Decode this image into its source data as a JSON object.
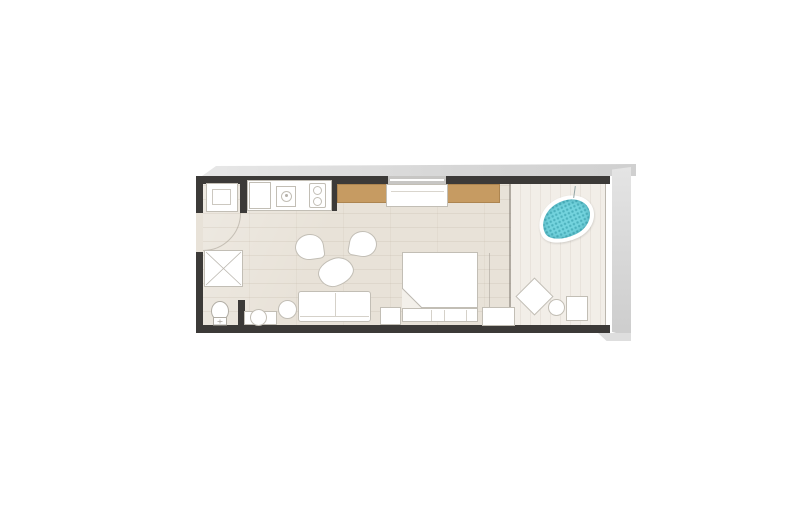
{
  "meta": {
    "type": "architectural-floor-plan",
    "description": "Hotel suite floor plan with kitchenette, bathroom, living-bedroom and terrace with private plunge pool",
    "visible_text": []
  },
  "colors": {
    "background": "#ffffff",
    "wall": "#3c3a38",
    "window": "#c7c6c4",
    "floor_interior": "#e8e2d8",
    "floor_terrace": "#f2eee8",
    "wood": "#c69b62",
    "wood_edge": "#ad8550",
    "pool_water": "#74d4de",
    "pool_dot": "#2e96a3",
    "furniture_fill": "#ffffff",
    "furniture_line": "#c2beb5",
    "slab": "#dadada"
  },
  "rooms": [
    {
      "id": "entry-hall",
      "label": "Entry hall"
    },
    {
      "id": "bathroom",
      "label": "Bathroom"
    },
    {
      "id": "kitchenette",
      "label": "Kitchenette"
    },
    {
      "id": "living-bedroom",
      "label": "Living / bedroom area"
    },
    {
      "id": "terrace",
      "label": "Terrace with plunge pool"
    }
  ],
  "furniture": [
    {
      "id": "washer",
      "label": "Washer / appliance niche"
    },
    {
      "id": "fridge",
      "label": "Refrigerator"
    },
    {
      "id": "kitchen-sink",
      "label": "Kitchen sink"
    },
    {
      "id": "cooktop",
      "label": "Two-burner cooktop"
    },
    {
      "id": "wardrobe",
      "label": "Wardrobe"
    },
    {
      "id": "dresser",
      "label": "Dresser / TV console"
    },
    {
      "id": "shower",
      "label": "Walk-in shower"
    },
    {
      "id": "toilet",
      "label": "Toilet"
    },
    {
      "id": "vanity-sink",
      "label": "Vanity with round basin"
    },
    {
      "id": "armchair",
      "label": "Fan armchair (x2)"
    },
    {
      "id": "coffee-table",
      "label": "Organic coffee table"
    },
    {
      "id": "sofa",
      "label": "Two-seat sofa"
    },
    {
      "id": "side-table",
      "label": "Round side table"
    },
    {
      "id": "bed",
      "label": "Double bed with folded duvet"
    },
    {
      "id": "nightstand",
      "label": "Nightstand (x2)"
    },
    {
      "id": "plunge-pool",
      "label": "Free-form plunge pool"
    },
    {
      "id": "lounge-chair",
      "label": "Diamond lounge chair"
    },
    {
      "id": "terrace-table",
      "label": "Round terrace table"
    },
    {
      "id": "terrace-chair",
      "label": "Terrace chair"
    }
  ]
}
